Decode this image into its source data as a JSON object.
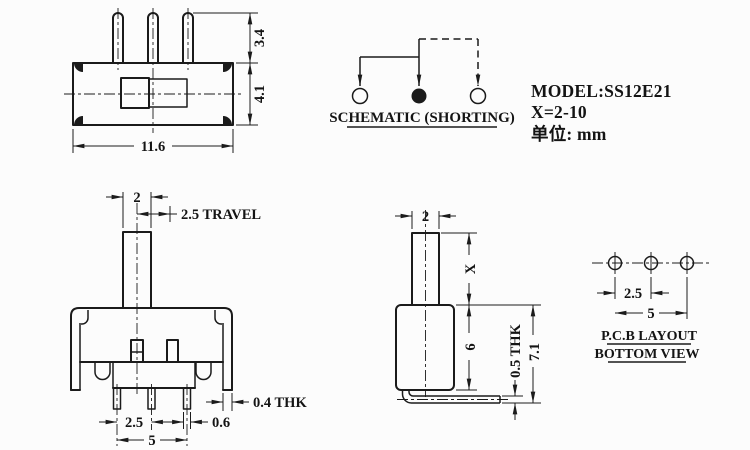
{
  "colors": {
    "line": "#1b1b1b",
    "background": "#fcfcfc"
  },
  "top_view": {
    "dim_pin_height": "3.4",
    "dim_body_height": "4.1",
    "dim_body_width": "11.6"
  },
  "schematic": {
    "label": "SCHEMATIC (SHORTING)"
  },
  "info": {
    "model": "MODEL:SS12E21",
    "x_range": "X=2-10",
    "unit": "单位: mm"
  },
  "front_view": {
    "dim_knob_width": "2",
    "dim_travel": "2.5 TRAVEL",
    "dim_pin_pitch": "2.5",
    "dim_pin_span": "5",
    "dim_pin_width": "0.6",
    "dim_cover_thickness": "0.4 THK"
  },
  "side_view": {
    "dim_knob_width": "2",
    "dim_knob_height": "X",
    "dim_body_height": "6",
    "dim_total_height": "7.1",
    "dim_pin_thickness": "0.5 THK"
  },
  "pcb_layout": {
    "dim_hole_pitch": "2.5",
    "dim_hole_span": "5",
    "title": "P.C.B LAYOUT",
    "subtitle": "BOTTOM VIEW"
  }
}
